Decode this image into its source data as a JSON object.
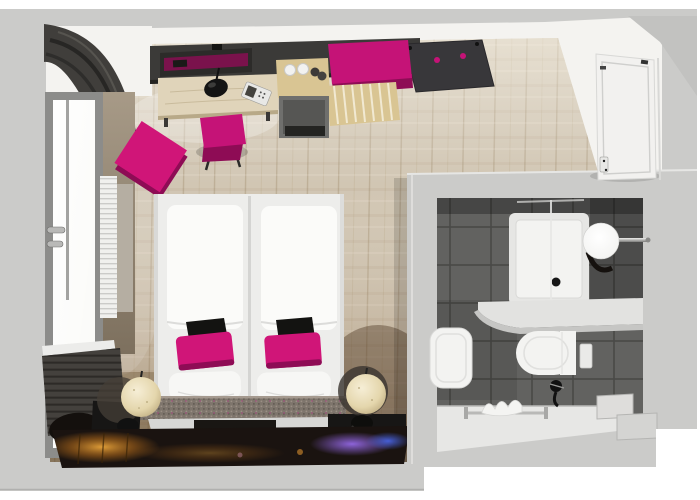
{
  "meta": {
    "title": "Top-down 3D rendering of a hotel room floor plan with en-suite bathroom"
  },
  "scene": {
    "description": "Top-down 3D rendering of a hotel room floor plan with en-suite bathroom",
    "rooms": [
      "bedroom",
      "bathroom"
    ],
    "bedroom_items": [
      "dark-curtains",
      "window",
      "window-handles",
      "radiator",
      "desk",
      "desk-lamp",
      "telephone",
      "desk-chair",
      "magenta-pouf",
      "dark-wall-panel-with-mirror",
      "minibar-with-cups",
      "coat-rack-panel",
      "magenta-bench",
      "wooden-luggage-rack",
      "twin-bed-left",
      "twin-bed-right",
      "white-duvets",
      "black-bed-runners",
      "magenta-pillows",
      "white-pillows",
      "padded-headboard-bench",
      "bedside-sphere-lamp-left",
      "bedside-sphere-lamp-right",
      "black-bedside-shelves",
      "glowing-rug",
      "white-entrance-door"
    ],
    "bathroom_items": [
      "grey-floor-tiles",
      "shower-tray",
      "glass-screen",
      "sphere-mirror-light",
      "white-counter",
      "washbasin",
      "toilet",
      "flush-plate",
      "black-fittings",
      "towel-rail",
      "white-towels",
      "corner-steps"
    ]
  },
  "colors": {
    "page_bg": "#ffffff",
    "outer_wall": "#cbcbc9",
    "outer_wall_dark": "#c2c2c0",
    "wall_white": "#f4f3f0",
    "floor_base": "#d1c6b3",
    "taupe_wall": "#9a8c7a",
    "curtain_dark": "#403e3b",
    "blind_dark": "#44413d",
    "frame_grey": "#8c8c8a",
    "glass_white": "#fafaf7",
    "radiator_white": "#f0f0ee",
    "panel_dark": "#3b3a38",
    "coat_panel_dark": "#38373a",
    "desk_wood": "#e0d4ba",
    "bench_wood": "#d9c593",
    "minibar_grey": "#6f6f6d",
    "magenta": "#c51377",
    "magenta_bright": "#d01578",
    "magenta_dark": "#8e0c55",
    "bed_base_white": "#ededeb",
    "duvet_white": "#fbfbf9",
    "pillow_white": "#f7f7f5",
    "runner_black": "#131311",
    "bench_taupe": "#7e756c",
    "platform_dark": "#21201e",
    "shelf_black": "#171615",
    "lamp_cream": "#e9dcb8",
    "rug_base": "#1a1310",
    "rug_orange": "#e09b28",
    "rug_purple": "#9a6cf0",
    "rug_blue": "#4a66e8",
    "tile_base": "#626260",
    "tile_grout": "#4a4a48",
    "fixture_white": "#f3f3f1",
    "counter_white": "#e2e2e0",
    "walkway_white": "#e7e7e5",
    "door_white": "#f2f1ef",
    "chrome": "#b9b9b7"
  }
}
